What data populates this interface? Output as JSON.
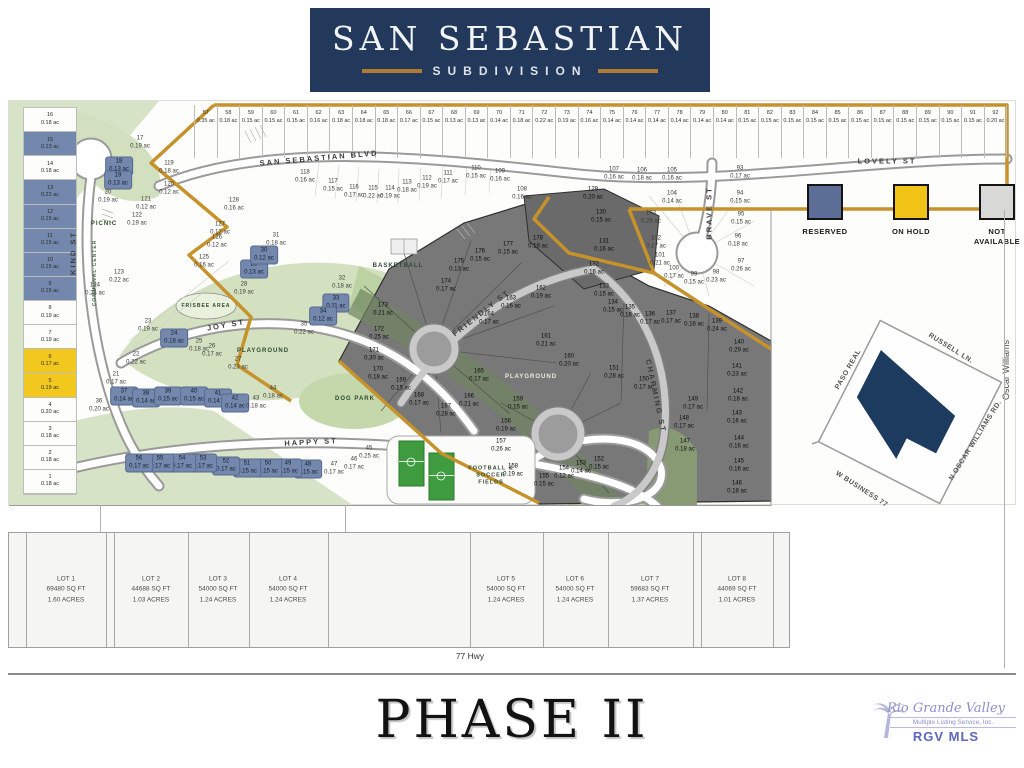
{
  "header": {
    "title": "SAN SEBASTIAN",
    "subtitle": "SUBDIVISION"
  },
  "legend": {
    "items": [
      {
        "label": "RESERVED",
        "color": "#5c6e95"
      },
      {
        "label": "ON HOLD",
        "color": "#f0c316"
      },
      {
        "label": "NOT AVAILABLE",
        "color": "#d8d8d6"
      }
    ]
  },
  "streets": {
    "san_sebastian": "SAN SEBASTIAN BLVD",
    "lovely": "LOVELY ST",
    "kind": "KIND ST",
    "communal": "COMMUNAL CENTER",
    "joy": "JOY ST",
    "happy": "HAPPY ST",
    "friendly": "FRIENDLY ST",
    "charming": "CHARMING ST",
    "brave": "BRAVE ST"
  },
  "amenities": {
    "picnic": "PICNIC",
    "basketball": "BASKETBALL",
    "frisbee": "FRISBEE AREA",
    "playground_west": "PLAYGROUND",
    "playground_center": "PLAYGROUND",
    "dog_park": "DOG PARK",
    "fields": "FOOTBALL & SOCCER FIELDS"
  },
  "inset": {
    "streets": {
      "paso_real": "PASO REAL",
      "russell": "RUSSELL LN.",
      "oscar_rd": "N OSCAR WILLIAMS RD.",
      "business": "W BUSINESS 77"
    },
    "shape_color": "#1d3a5f"
  },
  "right_edge_label": "Oscar Williams",
  "top_row_lots": [
    {
      "n": 57,
      "ac": "0.35 ac"
    },
    {
      "n": 58,
      "ac": "0.18 ac"
    },
    {
      "n": 59,
      "ac": "0.15 ac"
    },
    {
      "n": 60,
      "ac": "0.15 ac"
    },
    {
      "n": 61,
      "ac": "0.15 ac"
    },
    {
      "n": 62,
      "ac": "0.16 ac"
    },
    {
      "n": 63,
      "ac": "0.18 ac"
    },
    {
      "n": 64,
      "ac": "0.18 ac"
    },
    {
      "n": 65,
      "ac": "0.18 ac"
    },
    {
      "n": 66,
      "ac": "0.17 ac"
    },
    {
      "n": 67,
      "ac": "0.15 ac"
    },
    {
      "n": 68,
      "ac": "0.13 ac"
    },
    {
      "n": 69,
      "ac": "0.13 ac"
    },
    {
      "n": 70,
      "ac": "0.14 ac"
    },
    {
      "n": 71,
      "ac": "0.18 ac"
    },
    {
      "n": 72,
      "ac": "0.22 ac"
    },
    {
      "n": 73,
      "ac": "0.19 ac"
    },
    {
      "n": 74,
      "ac": "0.16 ac"
    },
    {
      "n": 75,
      "ac": "0.14 ac"
    },
    {
      "n": 76,
      "ac": "0.14 ac"
    },
    {
      "n": 77,
      "ac": "0.14 ac"
    },
    {
      "n": 78,
      "ac": "0.14 ac"
    },
    {
      "n": 79,
      "ac": "0.14 ac"
    },
    {
      "n": 80,
      "ac": "0.14 ac"
    },
    {
      "n": 81,
      "ac": "0.15 ac"
    },
    {
      "n": 82,
      "ac": "0.15 ac"
    },
    {
      "n": 83,
      "ac": "0.15 ac"
    },
    {
      "n": 84,
      "ac": "0.15 ac"
    },
    {
      "n": 85,
      "ac": "0.15 ac"
    },
    {
      "n": 86,
      "ac": "0.15 ac"
    },
    {
      "n": 87,
      "ac": "0.15 ac"
    },
    {
      "n": 88,
      "ac": "0.15 ac"
    },
    {
      "n": 89,
      "ac": "0.15 ac"
    },
    {
      "n": 90,
      "ac": "0.15 ac"
    },
    {
      "n": 91,
      "ac": "0.15 ac"
    },
    {
      "n": 92,
      "ac": "0.20 ac"
    }
  ],
  "left_col_lots": [
    {
      "n": 16,
      "ac": "0.18 ac",
      "t": "w"
    },
    {
      "n": 15,
      "ac": "0.13 ac",
      "t": "b"
    },
    {
      "n": 14,
      "ac": "0.18 ac",
      "t": "w"
    },
    {
      "n": 13,
      "ac": "0.22 ac",
      "t": "b"
    },
    {
      "n": 12,
      "ac": "0.15 ac",
      "t": "b"
    },
    {
      "n": 11,
      "ac": "0.15 ac",
      "t": "b"
    },
    {
      "n": 10,
      "ac": "0.15 ac",
      "t": "b"
    },
    {
      "n": 9,
      "ac": "0.16 ac",
      "t": "b"
    },
    {
      "n": 8,
      "ac": "0.19 ac",
      "t": "w"
    },
    {
      "n": 7,
      "ac": "0.19 ac",
      "t": "w"
    },
    {
      "n": 6,
      "ac": "0.17 ac",
      "t": "y"
    },
    {
      "n": 5,
      "ac": "0.19 ac",
      "t": "y"
    },
    {
      "n": 4,
      "ac": "0.20 ac",
      "t": "w"
    },
    {
      "n": 3,
      "ac": "0.18 ac",
      "t": "w"
    },
    {
      "n": 2,
      "ac": "0.18 ac",
      "t": "w"
    },
    {
      "n": 1,
      "ac": "0.18 ac",
      "t": "w"
    }
  ],
  "map_lots": [
    {
      "n": 17,
      "ac": "0.19 ac",
      "x": 131,
      "y": 42,
      "t": "w"
    },
    {
      "n": 18,
      "ac": "0.13 ac",
      "x": 110,
      "y": 65,
      "t": "b"
    },
    {
      "n": 19,
      "ac": "0.13 ac",
      "x": 109,
      "y": 79,
      "t": "b"
    },
    {
      "n": 20,
      "ac": "0.19 ac",
      "x": 99,
      "y": 96,
      "t": "w"
    },
    {
      "n": 119,
      "ac": "0.18 ac",
      "x": 160,
      "y": 67,
      "t": "w"
    },
    {
      "n": 120,
      "ac": "0.12 ac",
      "x": 160,
      "y": 88,
      "t": "w"
    },
    {
      "n": 121,
      "ac": "0.12 ac",
      "x": 137,
      "y": 103,
      "t": "w"
    },
    {
      "n": 122,
      "ac": "0.19 ac",
      "x": 128,
      "y": 119,
      "t": "w"
    },
    {
      "n": 123,
      "ac": "0.22 ac",
      "x": 110,
      "y": 176,
      "t": "w"
    },
    {
      "n": 124,
      "ac": "0.24 ac",
      "x": 86,
      "y": 189,
      "t": "w"
    },
    {
      "n": 125,
      "ac": "0.16 ac",
      "x": 195,
      "y": 161,
      "t": "w"
    },
    {
      "n": 126,
      "ac": "0.12 ac",
      "x": 208,
      "y": 141,
      "t": "w"
    },
    {
      "n": 127,
      "ac": "0.12 ac",
      "x": 211,
      "y": 128,
      "t": "w"
    },
    {
      "n": 128,
      "ac": "0.16 ac",
      "x": 225,
      "y": 104,
      "t": "w"
    },
    {
      "n": 28,
      "ac": "0.19 ac",
      "x": 235,
      "y": 188,
      "t": "w"
    },
    {
      "n": 29,
      "ac": "0.13 ac",
      "x": 245,
      "y": 168,
      "t": "b"
    },
    {
      "n": 30,
      "ac": "0.12 ac",
      "x": 255,
      "y": 154,
      "t": "b"
    },
    {
      "n": 31,
      "ac": "0.18 ac",
      "x": 267,
      "y": 139,
      "t": "w"
    },
    {
      "n": 32,
      "ac": "0.18 ac",
      "x": 333,
      "y": 182,
      "t": "w"
    },
    {
      "n": 33,
      "ac": "0.11 ac",
      "x": 327,
      "y": 202,
      "t": "b"
    },
    {
      "n": 34,
      "ac": "0.12 ac",
      "x": 314,
      "y": 215,
      "t": "b"
    },
    {
      "n": 35,
      "ac": "0.22 ac",
      "x": 295,
      "y": 228,
      "t": "w"
    },
    {
      "n": 23,
      "ac": "0.19 ac",
      "x": 139,
      "y": 225,
      "t": "w"
    },
    {
      "n": 24,
      "ac": "0.18 ac",
      "x": 165,
      "y": 237,
      "t": "b"
    },
    {
      "n": 25,
      "ac": "0.18 ac",
      "x": 190,
      "y": 245,
      "t": "w"
    },
    {
      "n": 26,
      "ac": "0.17 ac",
      "x": 203,
      "y": 250,
      "t": "w"
    },
    {
      "n": 27,
      "ac": "0.23 ac",
      "x": 229,
      "y": 263,
      "t": "w"
    },
    {
      "n": 21,
      "ac": "0.17 ac",
      "x": 107,
      "y": 278,
      "t": "w"
    },
    {
      "n": 22,
      "ac": "0.22 ac",
      "x": 127,
      "y": 258,
      "t": "w"
    },
    {
      "n": 36,
      "ac": "0.20 ac",
      "x": 90,
      "y": 305,
      "t": "w"
    },
    {
      "n": 37,
      "ac": "0.14 ac",
      "x": 115,
      "y": 295,
      "t": "b"
    },
    {
      "n": 38,
      "ac": "0.14 ac",
      "x": 137,
      "y": 297,
      "t": "b"
    },
    {
      "n": 39,
      "ac": "0.15 ac",
      "x": 159,
      "y": 295,
      "t": "b"
    },
    {
      "n": 40,
      "ac": "0.15 ac",
      "x": 185,
      "y": 295,
      "t": "b"
    },
    {
      "n": 41,
      "ac": "0.14 ac",
      "x": 209,
      "y": 297,
      "t": "b"
    },
    {
      "n": 42,
      "ac": "0.14 ac",
      "x": 226,
      "y": 302,
      "t": "b"
    },
    {
      "n": 43,
      "ac": "0.18 ac",
      "x": 247,
      "y": 302,
      "t": "w"
    },
    {
      "n": 44,
      "ac": "0.18 ac",
      "x": 264,
      "y": 292,
      "t": "w"
    },
    {
      "n": 45,
      "ac": "0.25 ac",
      "x": 360,
      "y": 352,
      "t": "w"
    },
    {
      "n": 46,
      "ac": "0.17 ac",
      "x": 345,
      "y": 363,
      "t": "w"
    },
    {
      "n": 47,
      "ac": "0.17 ac",
      "x": 325,
      "y": 368,
      "t": "w"
    },
    {
      "n": 48,
      "ac": "0.15 ac",
      "x": 299,
      "y": 368,
      "t": "b"
    },
    {
      "n": 49,
      "ac": "0.15 ac",
      "x": 279,
      "y": 367,
      "t": "b"
    },
    {
      "n": 50,
      "ac": "0.15 ac",
      "x": 259,
      "y": 367,
      "t": "b"
    },
    {
      "n": 51,
      "ac": "0.15 ac",
      "x": 238,
      "y": 367,
      "t": "b"
    },
    {
      "n": 52,
      "ac": "0.17 ac",
      "x": 217,
      "y": 365,
      "t": "b"
    },
    {
      "n": 53,
      "ac": "0.17 ac",
      "x": 194,
      "y": 362,
      "t": "b"
    },
    {
      "n": 54,
      "ac": "0.17 ac",
      "x": 173,
      "y": 362,
      "t": "b"
    },
    {
      "n": 55,
      "ac": "0.17 ac",
      "x": 151,
      "y": 362,
      "t": "b"
    },
    {
      "n": 56,
      "ac": "0.17 ac",
      "x": 130,
      "y": 362,
      "t": "b"
    },
    {
      "n": 118,
      "ac": "0.16 ac",
      "x": 296,
      "y": 76,
      "t": "w"
    },
    {
      "n": 117,
      "ac": "0.15 ac",
      "x": 324,
      "y": 85,
      "t": "w"
    },
    {
      "n": 116,
      "ac": "0.17 ac",
      "x": 345,
      "y": 91,
      "t": "w"
    },
    {
      "n": 115,
      "ac": "0.22 ac",
      "x": 364,
      "y": 92,
      "t": "w"
    },
    {
      "n": 114,
      "ac": "0.19 ac",
      "x": 381,
      "y": 92,
      "t": "w"
    },
    {
      "n": 113,
      "ac": "0.18 ac",
      "x": 398,
      "y": 86,
      "t": "w"
    },
    {
      "n": 112,
      "ac": "0.19 ac",
      "x": 418,
      "y": 82,
      "t": "w"
    },
    {
      "n": 111,
      "ac": "0.17 ac",
      "x": 439,
      "y": 77,
      "t": "w"
    },
    {
      "n": 110,
      "ac": "0.15 ac",
      "x": 467,
      "y": 72,
      "t": "w"
    },
    {
      "n": 109,
      "ac": "0.16 ac",
      "x": 491,
      "y": 75,
      "t": "w"
    },
    {
      "n": 108,
      "ac": "0.16 ac",
      "x": 513,
      "y": 93,
      "t": "w"
    },
    {
      "n": 93,
      "ac": "0.17 ac",
      "x": 731,
      "y": 72,
      "t": "w"
    },
    {
      "n": 94,
      "ac": "0.15 ac",
      "x": 731,
      "y": 97,
      "t": "w"
    },
    {
      "n": 95,
      "ac": "0.15 ac",
      "x": 732,
      "y": 118,
      "t": "w"
    },
    {
      "n": 96,
      "ac": "0.18 ac",
      "x": 729,
      "y": 140,
      "t": "w"
    },
    {
      "n": 97,
      "ac": "0.26 ac",
      "x": 732,
      "y": 165,
      "t": "w"
    },
    {
      "n": 98,
      "ac": "0.23 ac",
      "x": 707,
      "y": 176,
      "t": "w"
    },
    {
      "n": 99,
      "ac": "0.15 ac",
      "x": 685,
      "y": 178,
      "t": "w"
    },
    {
      "n": 100,
      "ac": "0.17 ac",
      "x": 665,
      "y": 172,
      "t": "w"
    },
    {
      "n": 101,
      "ac": "0.21 ac",
      "x": 651,
      "y": 159,
      "t": "w"
    },
    {
      "n": 102,
      "ac": "0.17 ac",
      "x": 647,
      "y": 142,
      "t": "w"
    },
    {
      "n": 103,
      "ac": "0.29 ac",
      "x": 642,
      "y": 117,
      "t": "w"
    },
    {
      "n": 104,
      "ac": "0.14 ac",
      "x": 663,
      "y": 97,
      "t": "w"
    },
    {
      "n": 105,
      "ac": "0.16 ac",
      "x": 663,
      "y": 74,
      "t": "w"
    },
    {
      "n": 106,
      "ac": "0.18 ac",
      "x": 633,
      "y": 74,
      "t": "w"
    },
    {
      "n": 107,
      "ac": "0.16 ac",
      "x": 605,
      "y": 73,
      "t": "w"
    },
    {
      "n": 129,
      "ac": "0.20 ac",
      "x": 584,
      "y": 93,
      "t": "d"
    },
    {
      "n": 130,
      "ac": "0.15 ac",
      "x": 592,
      "y": 116,
      "t": "d"
    },
    {
      "n": 131,
      "ac": "0.16 ac",
      "x": 595,
      "y": 145,
      "t": "d"
    },
    {
      "n": 132,
      "ac": "0.16 ac",
      "x": 585,
      "y": 168,
      "t": "d"
    },
    {
      "n": 133,
      "ac": "0.15 ac",
      "x": 595,
      "y": 190,
      "t": "d"
    },
    {
      "n": 134,
      "ac": "0.15 ac",
      "x": 604,
      "y": 206,
      "t": "d"
    },
    {
      "n": 135,
      "ac": "0.16 ac",
      "x": 621,
      "y": 211,
      "t": "d"
    },
    {
      "n": 136,
      "ac": "0.17 ac",
      "x": 641,
      "y": 218,
      "t": "d"
    },
    {
      "n": 137,
      "ac": "0.17 ac",
      "x": 662,
      "y": 217,
      "t": "d"
    },
    {
      "n": 138,
      "ac": "0.16 ac",
      "x": 685,
      "y": 220,
      "t": "d"
    },
    {
      "n": 139,
      "ac": "0.24 ac",
      "x": 708,
      "y": 225,
      "t": "d"
    },
    {
      "n": 140,
      "ac": "0.29 ac",
      "x": 730,
      "y": 246,
      "t": "d"
    },
    {
      "n": 141,
      "ac": "0.23 ac",
      "x": 728,
      "y": 270,
      "t": "d"
    },
    {
      "n": 142,
      "ac": "0.18 ac",
      "x": 729,
      "y": 295,
      "t": "d"
    },
    {
      "n": 143,
      "ac": "0.16 ac",
      "x": 728,
      "y": 317,
      "t": "d"
    },
    {
      "n": 144,
      "ac": "0.16 ac",
      "x": 730,
      "y": 342,
      "t": "d"
    },
    {
      "n": 145,
      "ac": "0.16 ac",
      "x": 730,
      "y": 365,
      "t": "d"
    },
    {
      "n": 146,
      "ac": "0.18 ac",
      "x": 728,
      "y": 387,
      "t": "d"
    },
    {
      "n": 147,
      "ac": "0.18 ac",
      "x": 676,
      "y": 345,
      "t": "d"
    },
    {
      "n": 148,
      "ac": "0.17 ac",
      "x": 675,
      "y": 322,
      "t": "d"
    },
    {
      "n": 149,
      "ac": "0.17 ac",
      "x": 684,
      "y": 303,
      "t": "d"
    },
    {
      "n": 150,
      "ac": "0.17 ac",
      "x": 635,
      "y": 283,
      "t": "d"
    },
    {
      "n": 151,
      "ac": "0.28 ac",
      "x": 605,
      "y": 272,
      "t": "d"
    },
    {
      "n": 152,
      "ac": "0.15 ac",
      "x": 590,
      "y": 363,
      "t": "d"
    },
    {
      "n": 153,
      "ac": "0.14 ac",
      "x": 572,
      "y": 367,
      "t": "d"
    },
    {
      "n": 154,
      "ac": "0.12 ac",
      "x": 555,
      "y": 372,
      "t": "d"
    },
    {
      "n": 155,
      "ac": "0.15 ac",
      "x": 535,
      "y": 380,
      "t": "d"
    },
    {
      "n": 156,
      "ac": "0.19 ac",
      "x": 497,
      "y": 325,
      "t": "d"
    },
    {
      "n": 157,
      "ac": "0.26 ac",
      "x": 492,
      "y": 345,
      "t": "d"
    },
    {
      "n": 158,
      "ac": "0.19 ac",
      "x": 504,
      "y": 370,
      "t": "d"
    },
    {
      "n": 159,
      "ac": "0.15 ac",
      "x": 509,
      "y": 303,
      "t": "d"
    },
    {
      "n": 160,
      "ac": "0.20 ac",
      "x": 560,
      "y": 260,
      "t": "d"
    },
    {
      "n": 161,
      "ac": "0.21 ac",
      "x": 537,
      "y": 240,
      "t": "d"
    },
    {
      "n": 162,
      "ac": "0.19 ac",
      "x": 532,
      "y": 192,
      "t": "d"
    },
    {
      "n": 163,
      "ac": "0.16 ac",
      "x": 502,
      "y": 202,
      "t": "d"
    },
    {
      "n": 164,
      "ac": "0.17 ac",
      "x": 480,
      "y": 218,
      "t": "d"
    },
    {
      "n": 165,
      "ac": "0.17 ac",
      "x": 470,
      "y": 275,
      "t": "d"
    },
    {
      "n": 166,
      "ac": "0.21 ac",
      "x": 460,
      "y": 300,
      "t": "d"
    },
    {
      "n": 167,
      "ac": "0.28 ac",
      "x": 437,
      "y": 310,
      "t": "d"
    },
    {
      "n": 168,
      "ac": "0.17 ac",
      "x": 410,
      "y": 299,
      "t": "d"
    },
    {
      "n": 169,
      "ac": "0.15 ac",
      "x": 392,
      "y": 284,
      "t": "d"
    },
    {
      "n": 170,
      "ac": "0.18 ac",
      "x": 369,
      "y": 273,
      "t": "d"
    },
    {
      "n": 171,
      "ac": "0.30 ac",
      "x": 365,
      "y": 254,
      "t": "d"
    },
    {
      "n": 172,
      "ac": "0.25 ac",
      "x": 370,
      "y": 233,
      "t": "d"
    },
    {
      "n": 173,
      "ac": "0.21 ac",
      "x": 374,
      "y": 209,
      "t": "d"
    },
    {
      "n": 174,
      "ac": "0.17 ac",
      "x": 437,
      "y": 185,
      "t": "d"
    },
    {
      "n": 175,
      "ac": "0.13 ac",
      "x": 450,
      "y": 165,
      "t": "d"
    },
    {
      "n": 176,
      "ac": "0.15 ac",
      "x": 471,
      "y": 155,
      "t": "d"
    },
    {
      "n": 177,
      "ac": "0.15 ac",
      "x": 499,
      "y": 148,
      "t": "d"
    },
    {
      "n": 178,
      "ac": "0.19 ac",
      "x": 529,
      "y": 142,
      "t": "d"
    }
  ],
  "bottom_lots": [
    {
      "name": "LOT 1",
      "sqft": "69480 SQ FT",
      "acres": "1.60 ACRES"
    },
    {
      "name": "LOT 2",
      "sqft": "44688 SQ FT",
      "acres": "1.03 ACRES"
    },
    {
      "name": "LOT 3",
      "sqft": "54000 SQ FT",
      "acres": "1.24 ACRES"
    },
    {
      "name": "LOT 4",
      "sqft": "54000 SQ FT",
      "acres": "1.24 ACRES"
    },
    {
      "name": "LOT 5",
      "sqft": "54000 SQ FT",
      "acres": "1.24 ACRES"
    },
    {
      "name": "LOT 6",
      "sqft": "54000 SQ FT",
      "acres": "1.24 ACRES"
    },
    {
      "name": "LOT 7",
      "sqft": "59683 SQ FT",
      "acres": "1.37 ACRES"
    },
    {
      "name": "LOT 8",
      "sqft": "44069 SQ FT",
      "acres": "1.01 ACRES"
    }
  ],
  "hwy_label": "77 Hwy",
  "phase_title": "PHASE II",
  "watermark": {
    "line1": "Rio Grande Valley",
    "line2": "Multiple Listing Service, Inc.",
    "line3": "RGV MLS"
  }
}
